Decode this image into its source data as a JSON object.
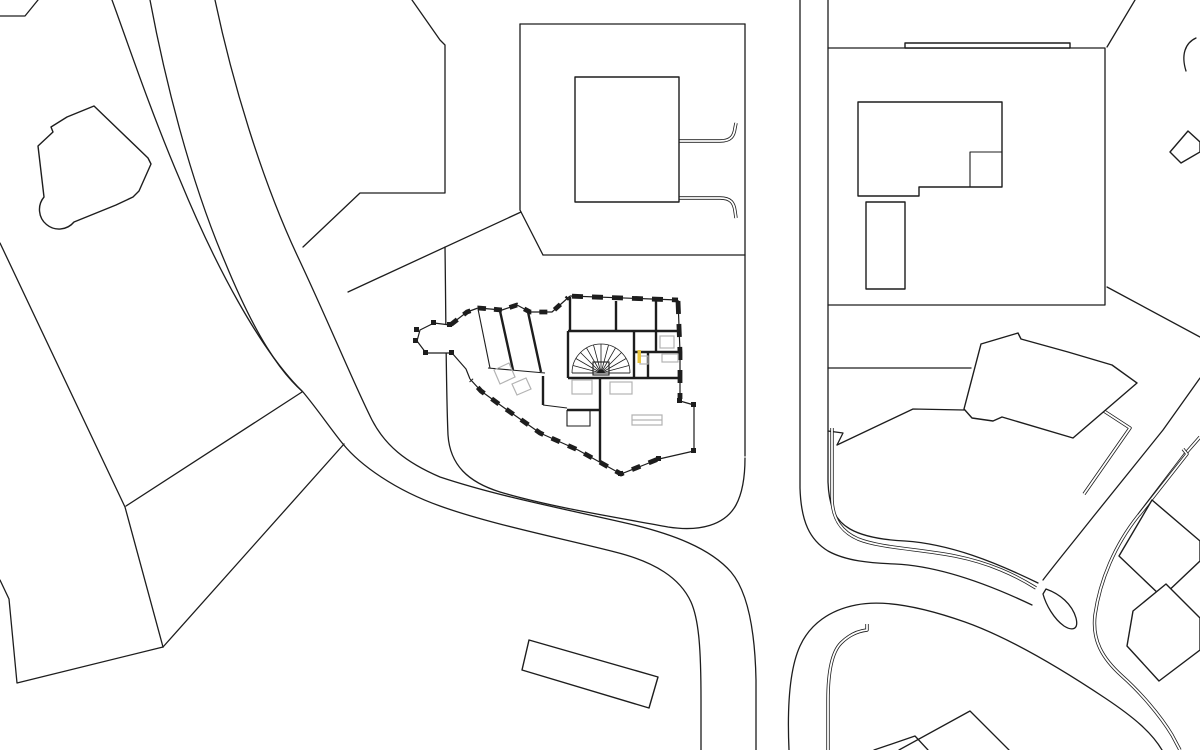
{
  "drawing": {
    "description": "Black-and-white architectural site plan; detailed ground-floor plan of a faceted apartment building at centre, surrounded by simplified neighbouring building footprints, parcel boundary lines and curved roads with kerb lines",
    "background": "#ffffff",
    "ink": "#1d1d1d",
    "fixture_gray": "#b3b3b3",
    "accent_yellow": "#e9c43a"
  },
  "features": {
    "roads": [
      "west-curved-road",
      "north-south-road",
      "northeast-diagonal-road",
      "south-loop-road"
    ],
    "buildings": [
      "top-left-house",
      "top-center-square-building",
      "top-right-l-building",
      "top-right-annex",
      "east-angled-building",
      "east-cluster",
      "bottom-center-building",
      "bottom-peaked-roofs",
      "central-detailed-floor-plan"
    ],
    "floor_plan_elements": [
      "spiral-stair",
      "elevator",
      "bathroom-fixtures",
      "yellow-door-marker",
      "window-piers",
      "bay-windows"
    ]
  }
}
